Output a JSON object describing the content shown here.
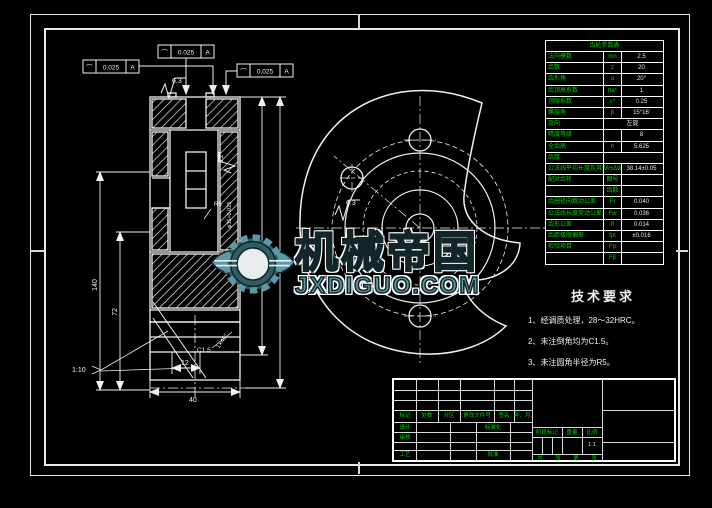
{
  "colors": {
    "line": "#f0f0f0",
    "green": "#00d400",
    "teal": "#5c99a6",
    "background": "#000000"
  },
  "watermark": {
    "brand": "机械帝国",
    "domain": "JXDIGUO.COM",
    "monogram": "JX"
  },
  "tech_requirements": {
    "title": "技术要求",
    "item1": "1、经调质处理，28～32HRC。",
    "item2": "2、未注倒角均为C1.5。",
    "item3": "3、未注圆角半径为R5。"
  },
  "gear_table": {
    "title": "齿轮参数表",
    "rows": [
      {
        "label": "法向模数",
        "sym": "mn",
        "val": "2.5"
      },
      {
        "label": "齿数",
        "sym": "z",
        "val": "20"
      },
      {
        "label": "齿形角",
        "sym": "α",
        "val": "20°"
      },
      {
        "label": "齿顶高系数",
        "sym": "ha*",
        "val": "1"
      },
      {
        "label": "顶隙系数",
        "sym": "c*",
        "val": "0.25"
      },
      {
        "label": "螺旋角",
        "sym": "β",
        "val": "15°16′"
      },
      {
        "label": "旋向",
        "val": "左旋",
        "span": true
      },
      {
        "label": "精度等级",
        "sym": "",
        "val": "8"
      },
      {
        "label": "全齿高",
        "sym": "h",
        "val": "5.625"
      },
      {
        "label": "齿厚",
        "val": "",
        "span": true
      },
      {
        "label": "公法线平均长度及其偏差",
        "sym": "W±ΔW",
        "val": "38.14±0.05"
      },
      {
        "label": "配对齿轮",
        "sym": "图号",
        "val": ""
      },
      {
        "label": "",
        "sym": "齿数",
        "val": ""
      },
      {
        "label": "齿圈径向跳动公差",
        "sym": "Fr",
        "val": "0.040"
      },
      {
        "label": "公法线长度变动公差",
        "sym": "Fw",
        "val": "0.036"
      },
      {
        "label": "齿形公差",
        "sym": "ff",
        "val": "0.014"
      },
      {
        "label": "齿距极限偏差",
        "sym": "fpt",
        "val": "±0.016"
      },
      {
        "label": "检验项目",
        "sym": "Fp",
        "val": ""
      },
      {
        "label": "",
        "sym": "Fβ",
        "val": ""
      }
    ]
  },
  "title_block": {
    "revision_headers": [
      "标记",
      "处数",
      "分区",
      "更改文件号",
      "签名",
      "年、月、日"
    ],
    "design": "设计",
    "check": "审核",
    "process": "工艺",
    "standardization": "标准化",
    "approve": "批准",
    "stage_label": "阶段标记",
    "weight_label": "重量",
    "scale_label": "比例",
    "scale_value": "1:1",
    "sheet_total": "共",
    "sheet_word1": "张",
    "sheet_page": "第",
    "sheet_word2": "张"
  },
  "annotations": {
    "tol_sym1": "⌒",
    "tol_val1": "0.025",
    "tol_datum1": "A",
    "tol_sym2": "⌒",
    "tol_val2": "0.025",
    "tol_datum2": "A",
    "tol_sym3": "⌒",
    "tol_val3": "0.025",
    "tol_datum3": "A",
    "ra_top": "6.3",
    "ra_right_view": "6.3",
    "ra_side": "3.2",
    "dim_140": "140",
    "dim_72": "72",
    "dim_12": "12",
    "dim_40": "40",
    "taper": "1:10",
    "chamfer_c": "C1.5",
    "fillet": "R5",
    "chamfer_angle": "1×45°",
    "bore": "φ35+0.025",
    "hole_note": "20"
  }
}
